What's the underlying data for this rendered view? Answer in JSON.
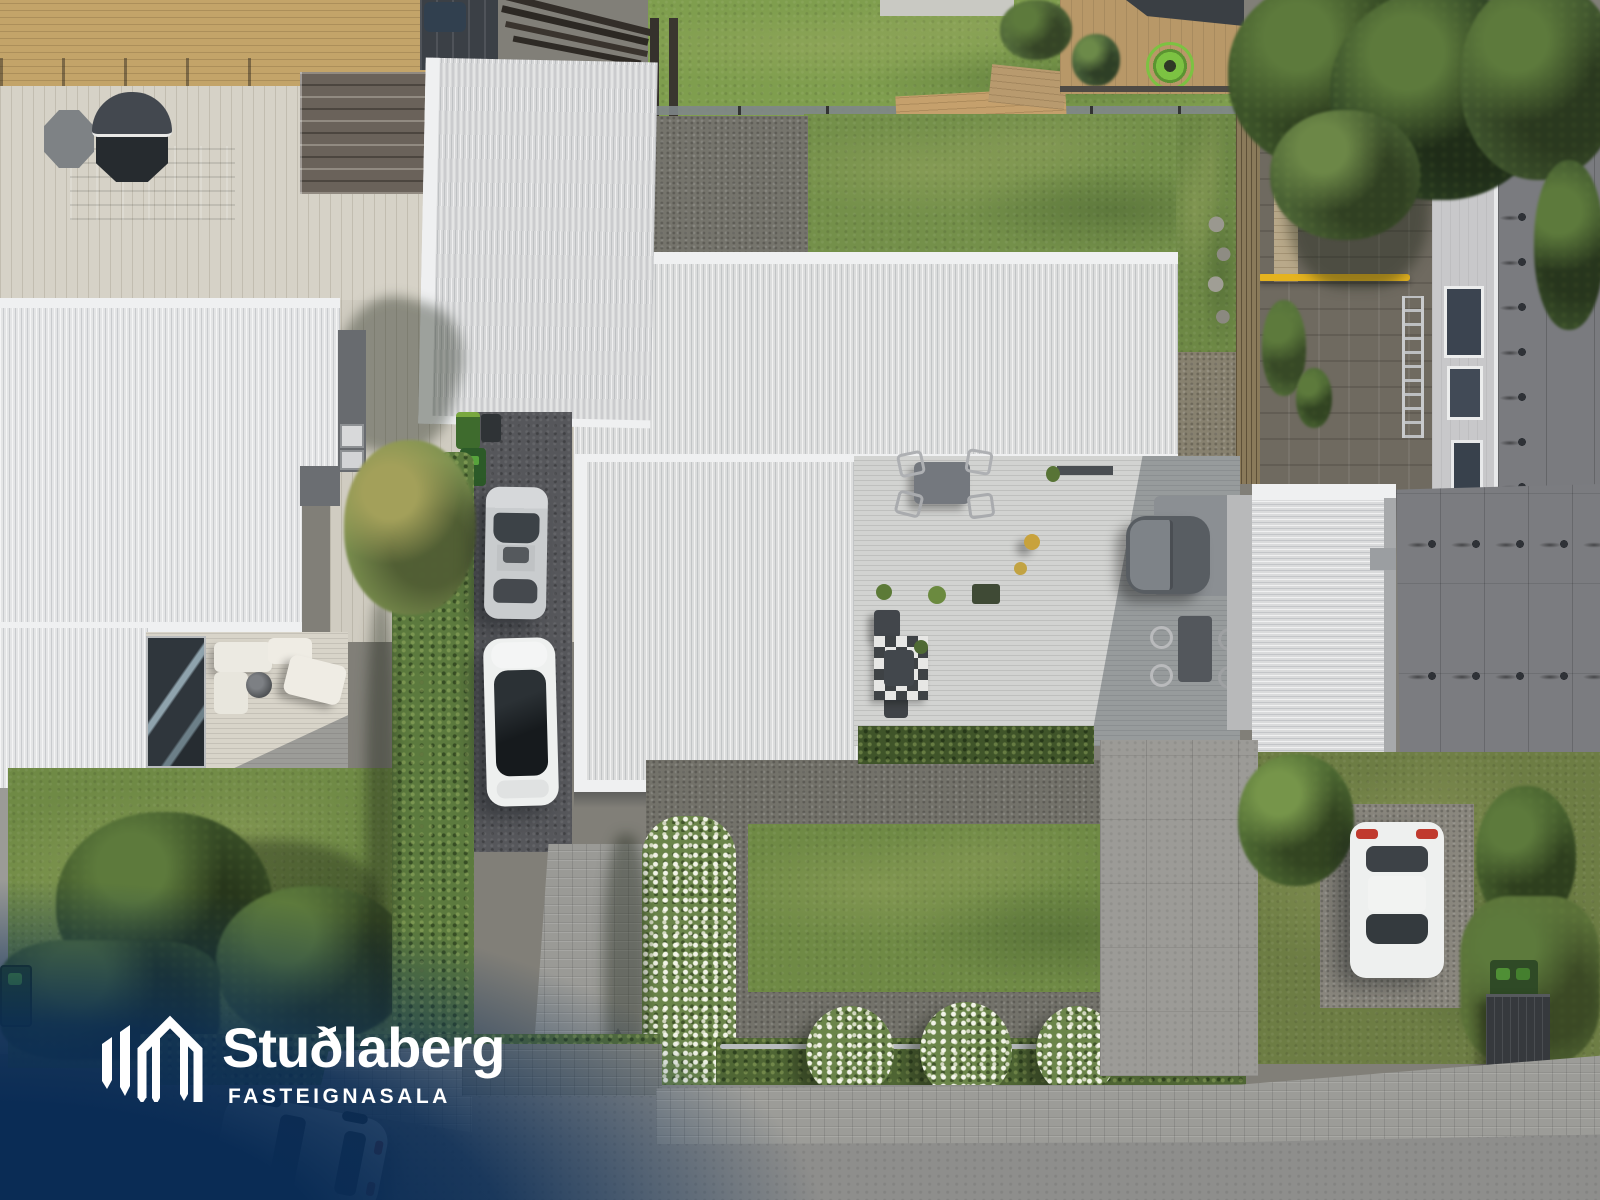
{
  "watermark": {
    "brand": "Stuðlaberg",
    "tagline": "FASTEIGNASALA",
    "logo_icon": "basalt-columns-logo",
    "text_color": "#ffffff",
    "overlay_color": "#0a2c55"
  },
  "scene": {
    "description": "Top-down aerial drone photo of residential houses: white corrugated metal roofs, gray timber sun deck with outdoor furniture and a hot tub, lawns, trimmed hedges with white flowering shrubs, gravel beds, paved driveways with parked cars, and a street along the bottom edge",
    "inventory": {
      "houses_visible": 4,
      "parked_cars": 4,
      "hot_tubs": 2,
      "white_flowering_bushes": 4,
      "wheelie_bins": 6,
      "ladders": 1,
      "lumber_piles": 3
    }
  },
  "palette": {
    "navy": "#0a2c55",
    "roofWhite": "#dcdddd",
    "roofBright": "#e4e5e6",
    "ridgeWhite": "#f1f2f3",
    "membrane": "#7a7b7f",
    "facade": "#c8c8ca",
    "woodTan": "#c3a469",
    "patioBeige": "#d6d2c7",
    "deckGray": "#d2d3d1",
    "asphaltDrive": "#56575b",
    "street": "#8e8e8c",
    "paver": "#9c9c98",
    "paverDark": "#83847f",
    "concrete": "#9c9b97",
    "gravel": "#79786f",
    "grassBack": "#74904a",
    "grassFront": "#6f8a45",
    "grassBright": "#7f9e4e",
    "hedge": "#5c7a3e",
    "hedgeDark": "#4f6634",
    "treeGreen": "#3c5329",
    "treeDeep": "#2f4425",
    "carSilver": "#c9ccce",
    "carWhite": "#eef0ef",
    "glassDark": "#23282c",
    "yellowPole": "#e5b31f",
    "reelGreen": "#7cc242",
    "binGreen": "#3e6b2d"
  }
}
